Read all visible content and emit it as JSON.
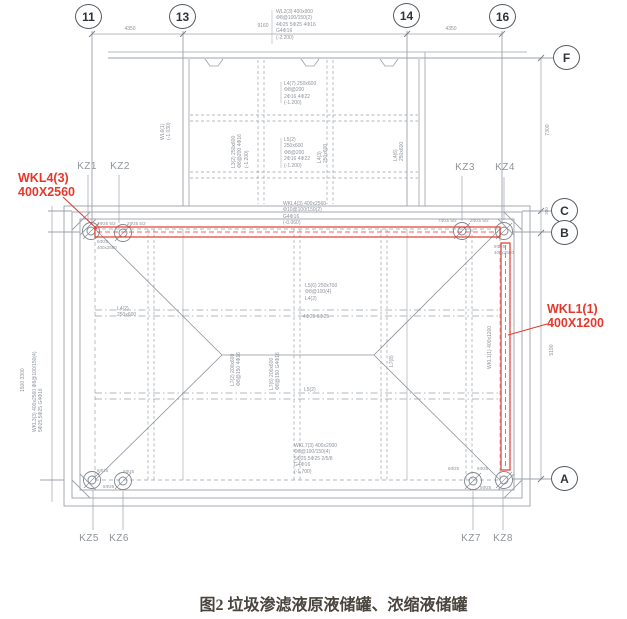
{
  "figure": {
    "caption": "图2 垃圾渗滤液原液储罐、浓缩液储罐"
  },
  "axes": {
    "top": [
      "11",
      "13",
      "14",
      "16"
    ],
    "right": [
      "F",
      "C",
      "B",
      "A"
    ]
  },
  "columns": [
    "KZ1",
    "KZ2",
    "KZ3",
    "KZ4",
    "KZ5",
    "KZ6",
    "KZ7",
    "KZ8"
  ],
  "callouts": {
    "wkl4": {
      "name": "WKL4(3)",
      "size": "400X2560"
    },
    "wkl1": {
      "name": "WKL1(1)",
      "size": "400X1200"
    }
  },
  "dimensions": {
    "top_left": "4350",
    "top_mid": "9160",
    "top_right": "4350",
    "right_upper": "7300",
    "right_mid": "350",
    "right_lower": "5190"
  },
  "annotations": {
    "top_block": "WL2(3) 400x900\nΦ8@100/150(2)\n4Φ25 5Φ25 4Φ16\nG4Φ16\n(-2.200)",
    "plat_upper": "L4(7) 250x600\nΦ8@200\n2Φ16 4Φ22\n(-1.200)",
    "plat_center": "L5(2)\n250x600\nΦ8@200\n2Φ16 4Φ22\n(-1.200)",
    "plat_left_rot": "L3(2) 250x600\nΦ8@200 4Φ16\n(-1.200)",
    "plat_rot_a": "L4(3)\n250x600",
    "plat_rot_b": "L4(6)\n250x600",
    "plat_edge_rot": "WL6(1)\n(-1.030)",
    "wkl4_spec": "WKL4(3) 400x2560\nΦ10@100/150(2)\nG4Φ16\n(-0.060)",
    "beam_top_l1": "3Φ25 5/2",
    "beam_top_l2": "2Φ25 5/2",
    "beam_top_r1": "7Φ25 5/2",
    "beam_top_r2": "2Φ25 5/2",
    "kz1_spec": "5Φ25\n400x2560",
    "kz4_spec": "5Φ25\n400x2560",
    "center_a": "L5(6) 250x700\nΦ8@100(4)\nL4(2)",
    "center_b": "4Φ25 6Φ25",
    "center_c": "L5(2)",
    "center_rot_a": "L7(2) 200x600\nΦ8@150 4Φ16",
    "center_rot_b": "L7(6) 200x600\nΦ8@150 G4Φ16",
    "center_rot_c": "L7(8)",
    "left_beam": "L4(2)\n250x600",
    "left_wall_rot": "WKL3(3) 400x2560 Φ8@100/150(4)\n5Φ25,5Φ25 G4Φ16",
    "left_dim_rot": "1500 3300",
    "bottom_spec": "WKL7(3) 400x2000\nΦ8@100/150(4)\n5Φ25,5Φ25 2/5/8\nG4Φ16\n(-1.700)",
    "kz5_a": "6Φ25",
    "kz6_a": "6Φ25",
    "kz56_b": "5Φ25",
    "kz7_a": "6Φ25",
    "kz8_a": "6Φ25",
    "kz8_b": "5Φ25",
    "wkl1_rot": "WKL1(1) 400x1200"
  },
  "colors": {
    "highlight_red": "#e5372b",
    "linework_gray": "#9ba1a9",
    "label_gray": "#8d929a",
    "axis_dark": "#3f444c",
    "caption_dark": "#4a443e"
  }
}
